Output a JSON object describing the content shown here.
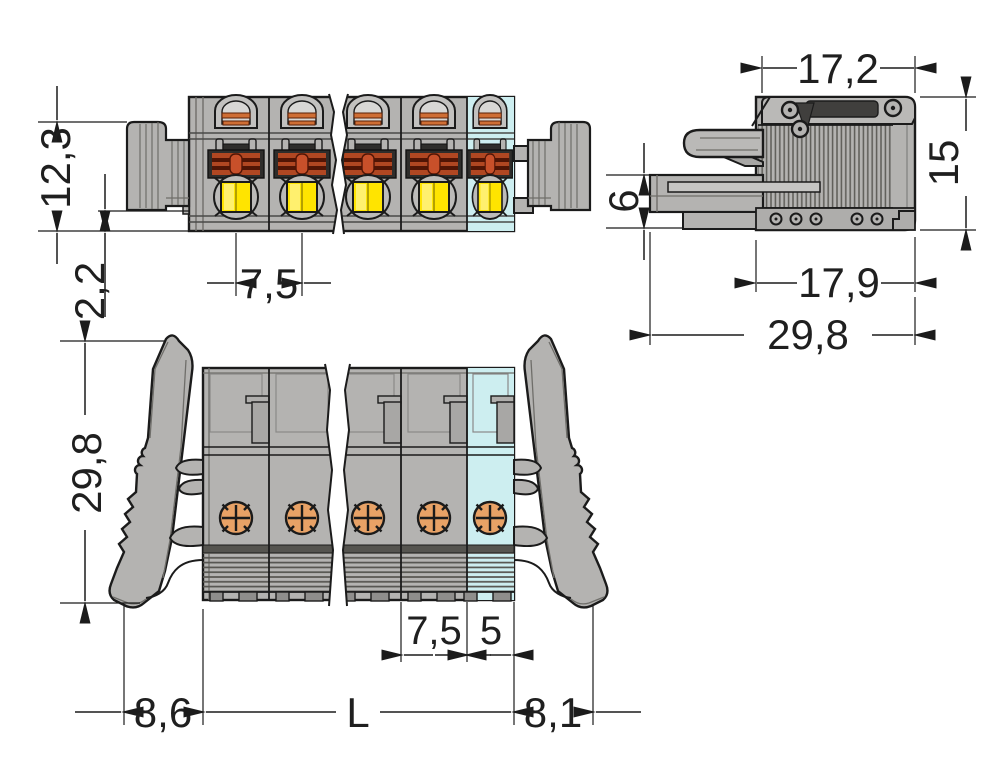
{
  "drawing": {
    "views": {
      "top": {
        "dims": {
          "height": "12,3",
          "base_height": "2,2",
          "pole_pitch": "7,5"
        }
      },
      "side": {
        "dims": {
          "top_width": "17,2",
          "shroud_height": "6",
          "height": "15",
          "body_width": "17,9",
          "total_depth": "29,8"
        }
      },
      "front": {
        "dims": {
          "total_height": "29,8",
          "pole_pitch": "7,5",
          "end_module": "5",
          "left_offset": "8,6",
          "total_length": "L",
          "right_offset": "8,1"
        }
      }
    },
    "colors": {
      "body": "#b4b3b1",
      "highlight_pole": "#cdeef0",
      "push_button": "#ffe400",
      "contact": "#e8a266",
      "clamp": "#b04722",
      "outline": "#1b1b1b",
      "background": "#ffffff"
    }
  }
}
